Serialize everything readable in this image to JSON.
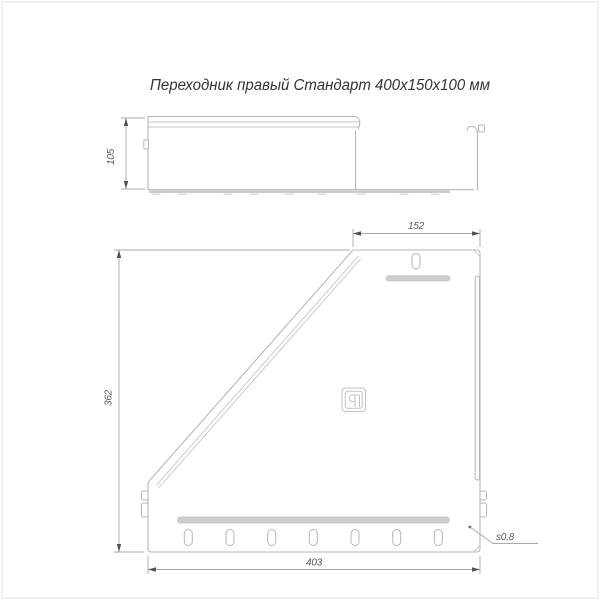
{
  "page": {
    "title": "Переходник правый Стандарт 400х150х100 мм"
  },
  "dimensions": {
    "profile_height": "105",
    "top_width": "152",
    "left_height": "362",
    "bottom_width": "403",
    "thickness": "s0,8"
  },
  "icons": {
    "brand_logo": "paragraph-mark-badge-logo"
  },
  "features": {
    "top_slots": 1,
    "bottom_slots": 7,
    "top_beads": 1,
    "bottom_beads": 1
  },
  "colors": {
    "background": "#ffffff",
    "part_line": "#b3b7ba",
    "bead_fill": "#ccd0d2",
    "dimension_line": "#a6aaad",
    "dimension_text": "#54575a",
    "title_text": "#303438",
    "border": "#e0e0e0"
  }
}
